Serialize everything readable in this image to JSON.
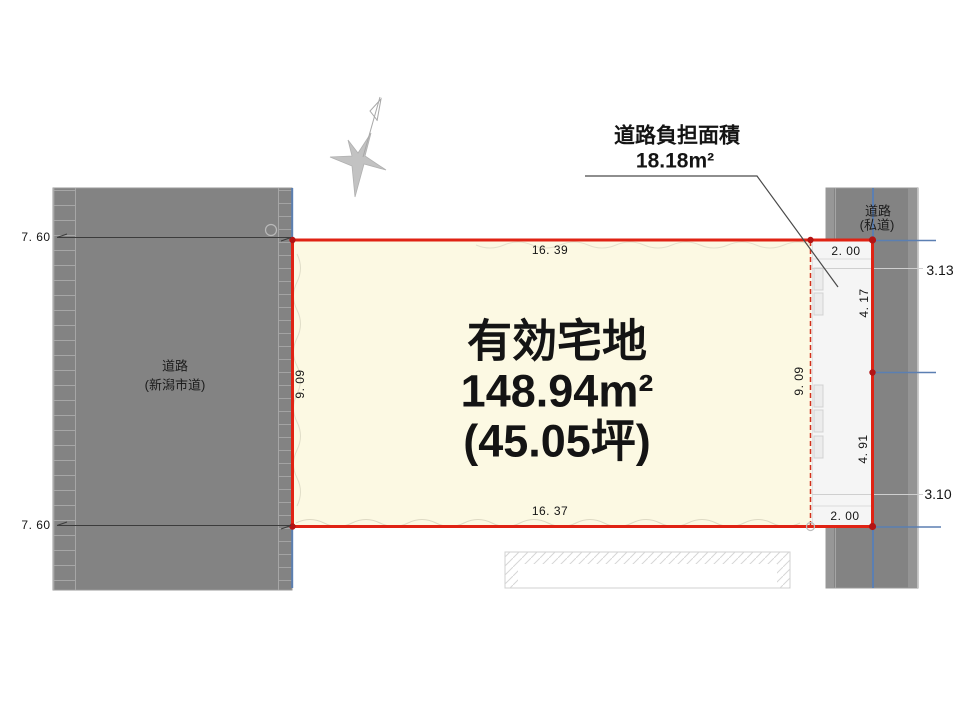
{
  "annotation": {
    "title": "道路負担面積",
    "value": "18.18m²"
  },
  "parcel": {
    "label": "有効宅地",
    "area_sqm": "148.94m²",
    "area_tsubo": "(45.05坪)"
  },
  "left_road": {
    "name": "道路",
    "type": "(新潟市道)"
  },
  "right_road": {
    "name": "道路",
    "type": "(私道)"
  },
  "dims": {
    "road_width_top": "7. 60",
    "road_width_bottom": "7. 60",
    "parcel_top": "16. 39",
    "parcel_bottom": "16. 37",
    "parcel_left": "9. 09",
    "parcel_right": "9. 09",
    "burden_top": "2. 00",
    "burden_bottom": "2. 00",
    "burden_upper": "4. 17",
    "burden_lower": "4. 91",
    "offset_upper": "3.13",
    "offset_lower": "3.10"
  },
  "colors": {
    "parcel_fill": "#fcf9e3",
    "boundary_red": "#e02314",
    "road_gray": "#838383",
    "reference_blue": "#5b7fb2",
    "burden_strip": "#f5f5f5"
  }
}
